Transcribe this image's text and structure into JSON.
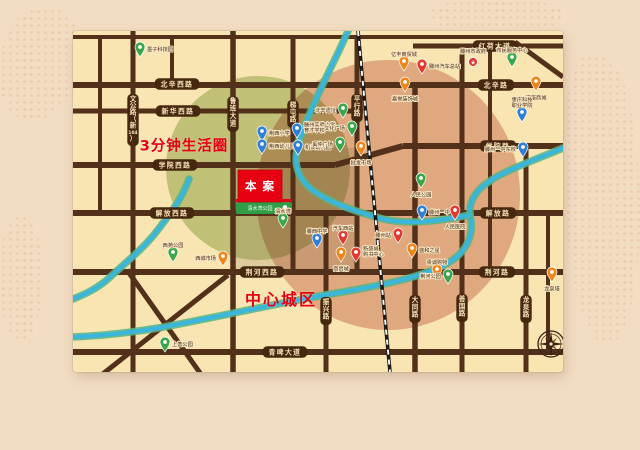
{
  "map": {
    "project_label": "本案",
    "park_banner": "清水湾公园",
    "circle_labels": {
      "life_circle": "3分钟生活圈",
      "downtown": "中心城区"
    },
    "colors": {
      "panel": "#f8e5b2",
      "road": "#52301a",
      "pill": "#46280f",
      "pill_text": "#f7e3b8",
      "river": "#3ab5dc",
      "river_edge": "#58b580",
      "label": "#4a2a14",
      "accent_red": "#e60012",
      "park_green": "#2f9e47",
      "block": "#7a6a48",
      "compass": "#3a2210",
      "pin": {
        "blue": "#2f7fd4",
        "green": "#3ba54a",
        "orange": "#f08519",
        "red": "#e23a2e"
      }
    },
    "pin_path": "M0 0C-3.4 -4.8 -5 -7.6 -5 -10a5 5 0 1 1 10 0C5 -7.6 3.4 -4.8 0 0Z",
    "zones": [
      {
        "name": "life-circle-zone",
        "cx": 185,
        "cy": 137,
        "rx": 92,
        "ry": 92,
        "color": "#8fae56",
        "opacity": 0.5
      },
      {
        "name": "downtown-zone",
        "cx": 315,
        "cy": 164,
        "rx": 132,
        "ry": 135,
        "color": "#cf7d72",
        "opacity": 0.52
      }
    ],
    "blocks": [
      [
        162,
        136,
        57,
        45
      ],
      [
        162,
        184,
        57,
        56
      ],
      [
        221,
        117,
        62,
        64
      ],
      [
        221,
        183,
        62,
        57
      ]
    ],
    "road_segments": [
      [
        0,
        6,
        490,
        6,
        4
      ],
      [
        340,
        15,
        490,
        15,
        5
      ],
      [
        0,
        54,
        490,
        54,
        6
      ],
      [
        0,
        80,
        290,
        80,
        5
      ],
      [
        0,
        134,
        262,
        134,
        6
      ],
      [
        262,
        134,
        330,
        115,
        6
      ],
      [
        330,
        115,
        490,
        115,
        6
      ],
      [
        0,
        182,
        490,
        182,
        6
      ],
      [
        0,
        241,
        490,
        241,
        6
      ],
      [
        0,
        321,
        490,
        321,
        6
      ],
      [
        27,
        6,
        27,
        182,
        4
      ],
      [
        60,
        0,
        60,
        341,
        5
      ],
      [
        99,
        6,
        99,
        54,
        4
      ],
      [
        160,
        0,
        160,
        341,
        5.5
      ],
      [
        220,
        6,
        220,
        241,
        5
      ],
      [
        253,
        182,
        253,
        341,
        5
      ],
      [
        284,
        6,
        284,
        241,
        5
      ],
      [
        342,
        54,
        342,
        341,
        5.5
      ],
      [
        389,
        15,
        389,
        341,
        5
      ],
      [
        417,
        15,
        417,
        241,
        4
      ],
      [
        453,
        115,
        453,
        341,
        5
      ],
      [
        475,
        182,
        475,
        321,
        4
      ],
      [
        54,
        239,
        137,
        356,
        5
      ],
      [
        155,
        244,
        12,
        357,
        5
      ],
      [
        442,
        11,
        490,
        46,
        5
      ]
    ],
    "railway": [
      285,
      0,
      317,
      341
    ],
    "rivers": [
      "M490,117 C455,132 420,143 405,160 C396,171 396,178 398,190 C400,207 392,222 375,232 C348,247 305,255 258,263 C205,272 140,287 85,297 C55,302 25,305 0,306",
      "M275,0 C262,30 240,70 226,110 C221,128 222,140 232,152 C246,168 280,180 310,188 C340,195 375,188 397,184",
      "M116,148 C108,170 96,184 84,200 C70,218 52,232 36,247 C24,258 10,264 0,268"
    ],
    "road_labels": [
      {
        "text": "北辛西路",
        "x": 104,
        "y": 53
      },
      {
        "text": "新华西路",
        "x": 105,
        "y": 80
      },
      {
        "text": "学院西路",
        "x": 102,
        "y": 134
      },
      {
        "text": "解放西路",
        "x": 99,
        "y": 182
      },
      {
        "text": "荆河西路",
        "x": 189,
        "y": 241
      },
      {
        "text": "青啤大道",
        "x": 212,
        "y": 321
      },
      {
        "text": "红荷大道",
        "x": 422,
        "y": 15
      },
      {
        "text": "北辛路",
        "x": 423,
        "y": 54
      },
      {
        "text": "学院路",
        "x": 425,
        "y": 115
      },
      {
        "text": "解放路",
        "x": 425,
        "y": 182
      },
      {
        "text": "荆河路",
        "x": 424,
        "y": 241
      },
      {
        "text": "文公路（新104）",
        "v": true,
        "chars": [
          "文",
          "公",
          "路",
          "（",
          "新",
          "104",
          "）"
        ],
        "sp": 6.6,
        "x": 60,
        "y": 89
      },
      {
        "text": "鲁班大道",
        "v": true,
        "x": 160,
        "y": 83
      },
      {
        "text": "梯屯路",
        "v": true,
        "x": 220,
        "y": 83
      },
      {
        "text": "平行路",
        "v": true,
        "x": 284,
        "y": 77
      },
      {
        "text": "振兴路",
        "v": true,
        "x": 253,
        "y": 280
      },
      {
        "text": "大同路",
        "v": true,
        "x": 342,
        "y": 278
      },
      {
        "text": "善国路",
        "v": true,
        "x": 389,
        "y": 277
      },
      {
        "text": "龙泉路",
        "v": true,
        "x": 453,
        "y": 278
      }
    ],
    "pois": [
      {
        "x": 67,
        "y": 26,
        "c": "green",
        "label": "墨子科技园",
        "pos": "right"
      },
      {
        "x": 189,
        "y": 110,
        "c": "blue",
        "label": "荆西小学",
        "pos": "right"
      },
      {
        "x": 189,
        "y": 123,
        "c": "blue",
        "label": "荆西幼儿园",
        "pos": "right"
      },
      {
        "x": 224,
        "y": 107,
        "c": "blue",
        "label": "滕州实验小学",
        "label2": "育才学校",
        "pos": "right"
      },
      {
        "x": 225,
        "y": 124,
        "c": "blue",
        "label": "机关幼儿园",
        "pos": "right"
      },
      {
        "x": 270,
        "y": 87,
        "c": "green",
        "label": "北辛遗址",
        "pos": "left"
      },
      {
        "x": 279,
        "y": 105,
        "c": "green",
        "label": "文化广场",
        "pos": "left"
      },
      {
        "x": 267,
        "y": 121,
        "c": "green",
        "label": "奚仲广场",
        "pos": "left"
      },
      {
        "x": 288,
        "y": 125,
        "c": "orange",
        "label": "批发市场",
        "pos": "below"
      },
      {
        "x": 244,
        "y": 217,
        "c": "blue",
        "label": "滕西中学",
        "pos": "above"
      },
      {
        "x": 210,
        "y": 197,
        "c": "green",
        "label": "清水湾",
        "pos": "above"
      },
      {
        "x": 100,
        "y": 231,
        "c": "green",
        "label": "西苑公园",
        "pos": "above"
      },
      {
        "x": 150,
        "y": 235,
        "c": "orange",
        "label": "西城市场",
        "pos": "left"
      },
      {
        "x": 92,
        "y": 321,
        "c": "green",
        "label": "上善公园",
        "pos": "right"
      },
      {
        "x": 270,
        "y": 214,
        "c": "red",
        "label": "汽车西站",
        "pos": "above"
      },
      {
        "x": 283,
        "y": 231,
        "c": "red",
        "label": "新盛城",
        "label2": "购书中心",
        "pos": "right"
      },
      {
        "x": 268,
        "y": 231,
        "c": "orange",
        "label": "商贸城",
        "pos": "below"
      },
      {
        "x": 400,
        "y": 37,
        "c": "redstar",
        "label": "滕州市政府",
        "pos": "above"
      },
      {
        "x": 439,
        "y": 36,
        "c": "green",
        "label": "市民服务中心",
        "pos": "above"
      },
      {
        "x": 463,
        "y": 60,
        "c": "orange",
        "label": "银座商城",
        "pos": "below"
      },
      {
        "x": 331,
        "y": 40,
        "c": "orange",
        "label": "亿丰商贸城",
        "pos": "above"
      },
      {
        "x": 349,
        "y": 43,
        "c": "red",
        "label": "滕州汽车总站",
        "pos": "right"
      },
      {
        "x": 332,
        "y": 61,
        "c": "orange",
        "label": "嘉誉装饰城",
        "pos": "below"
      },
      {
        "x": 449,
        "y": 91,
        "c": "blue",
        "label": "枣庄科技",
        "label2": "职业学院",
        "pos": "above"
      },
      {
        "x": 450,
        "y": 126,
        "c": "blue",
        "label": "滕州一中东校",
        "pos": "left"
      },
      {
        "x": 348,
        "y": 157,
        "c": "green",
        "label": "人民公园",
        "pos": "below"
      },
      {
        "x": 349,
        "y": 189,
        "c": "blue",
        "label": "滕州一中",
        "pos": "right"
      },
      {
        "x": 382,
        "y": 189,
        "c": "red",
        "label": "人民医院",
        "pos": "below"
      },
      {
        "x": 325,
        "y": 212,
        "c": "red",
        "label": "滕州站",
        "pos": "left"
      },
      {
        "x": 339,
        "y": 227,
        "c": "orange",
        "label": "盛和之星",
        "pos": "right"
      },
      {
        "x": 364,
        "y": 248,
        "c": "orange",
        "label": "贵诚购物",
        "pos": "above"
      },
      {
        "x": 375,
        "y": 253,
        "c": "green",
        "label": "荆河公园",
        "pos": "left"
      },
      {
        "x": 479,
        "y": 251,
        "c": "orange",
        "label": "龙泉塔",
        "pos": "below"
      }
    ],
    "project_box": [
      165,
      139,
      44,
      32
    ],
    "banner_box": [
      163,
      168,
      56,
      15
    ],
    "compass": {
      "cx": 478,
      "cy": 313
    }
  }
}
